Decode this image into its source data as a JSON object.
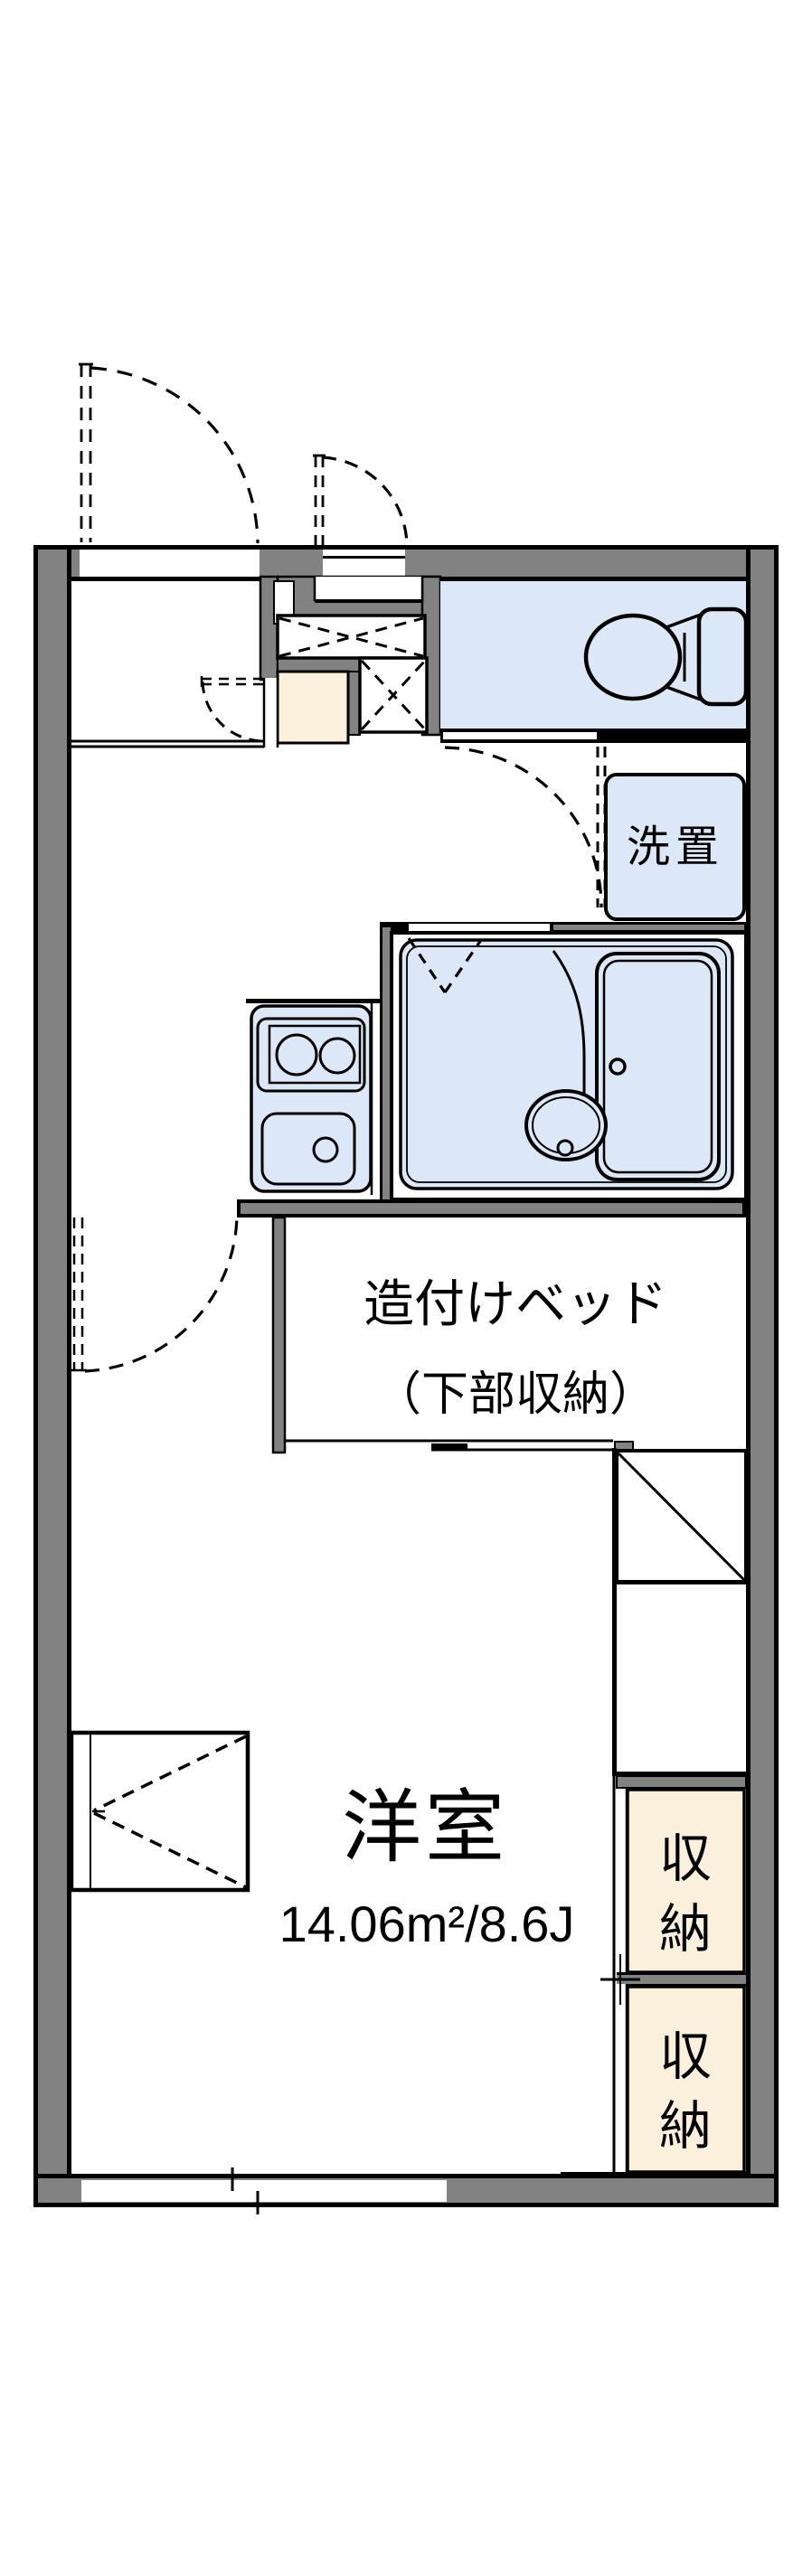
{
  "plan": {
    "title": "apartment-floor-plan",
    "labels": {
      "washer_place": "洗置",
      "bed_line1": "造付けベッド",
      "bed_line2": "（下部収納）",
      "western_room": "洋室",
      "western_room_area": "14.06m²/8.6J",
      "closet_upper": "収納",
      "closet_lower": "収納"
    },
    "colors": {
      "wall_gray": "#828282",
      "wet_area_blue": "#dce8f8",
      "closet_cream": "#faf0db",
      "line_black": "#000000",
      "background": "#ffffff"
    }
  }
}
